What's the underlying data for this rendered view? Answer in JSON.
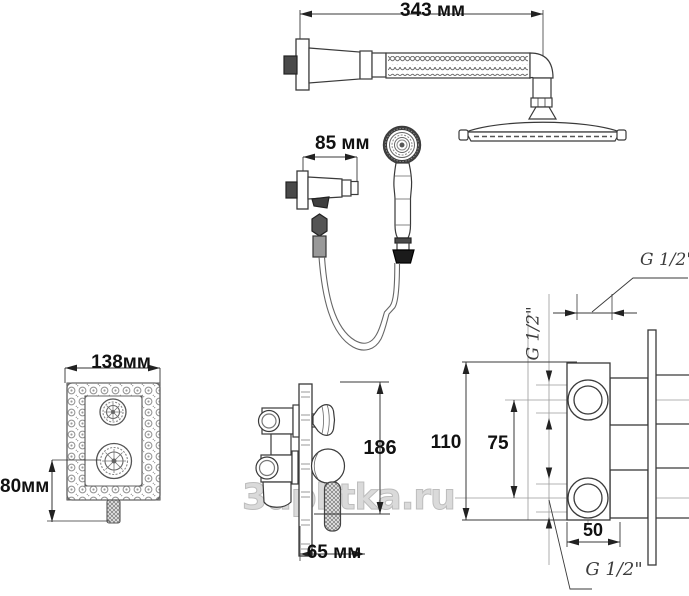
{
  "watermark": "3dplitka.ru",
  "dims": {
    "arm_length": "343 мм",
    "bracket_depth": "85 мм",
    "plate_width": "138мм",
    "plate_height": "80мм",
    "trim_height": "186",
    "trim_depth": "65 мм",
    "body_height": "110",
    "port_spacing": "75",
    "body_width": "50"
  },
  "threads": {
    "top": "G 1/2\"",
    "side": "G 1/2\"",
    "bottom": "G 1/2\""
  },
  "colors": {
    "line": "#3a3a3a",
    "dim_text": "#111111",
    "watermark": "#c9c9c9",
    "background": "#ffffff"
  }
}
